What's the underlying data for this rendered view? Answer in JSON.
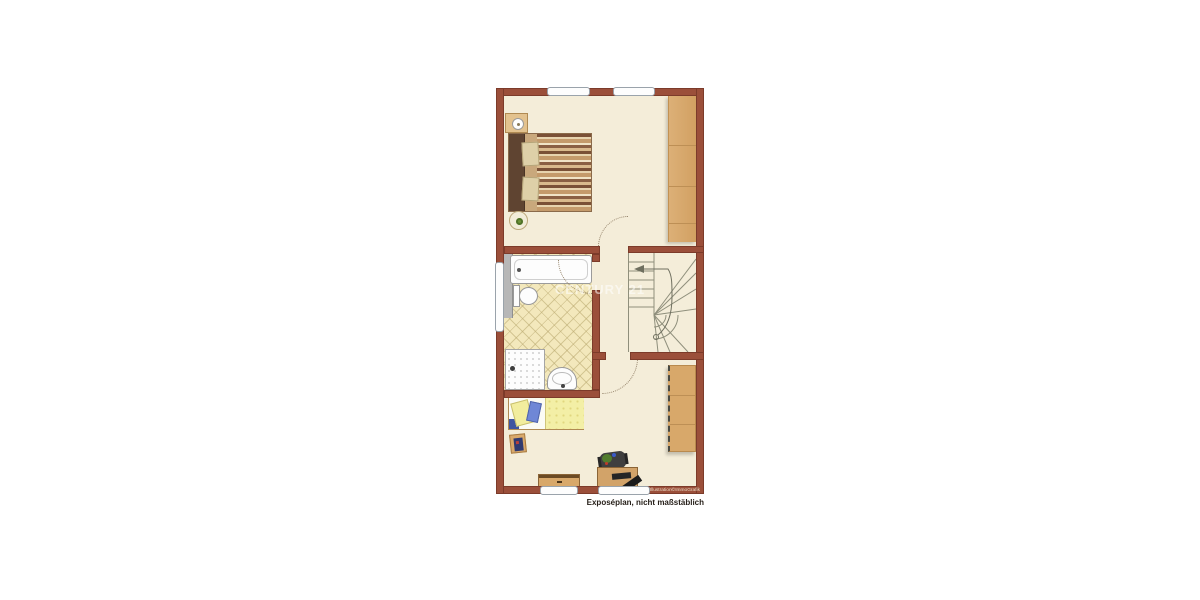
{
  "page": {
    "background": "#ffffff"
  },
  "plan": {
    "caption": "Exposéplan, nicht maßstäblich",
    "credit": "Illustration©ImmoGrafik",
    "watermark": "CENTURY 21",
    "palette": {
      "wall": "#9b4f3a",
      "floor": "#f4edd9",
      "wood": "#d8a86a",
      "tile": "#f3e8bc",
      "fixture_white": "#fdfdfd",
      "duvet_yellow": "#f3efa6",
      "cushion_blue": "#6f87d6"
    },
    "rooms": [
      {
        "name": "bedroom",
        "position": "top",
        "furniture": [
          "double-bed",
          "wardrobe",
          "nightstand-with-lamp",
          "round-plant-table"
        ]
      },
      {
        "name": "bathroom",
        "position": "middle-left",
        "furniture": [
          "bathtub",
          "toilet",
          "shower",
          "sink"
        ],
        "floor": "tiled"
      },
      {
        "name": "stair-hall",
        "position": "middle-right",
        "furniture": [
          "winder-staircase"
        ]
      },
      {
        "name": "children-room",
        "position": "bottom",
        "furniture": [
          "single-bed",
          "book",
          "shelf-unit",
          "desk",
          "office-chair",
          "desk-plant",
          "sideboard"
        ]
      }
    ],
    "openings": {
      "windows": [
        "top-wall-left",
        "top-wall-right",
        "left-wall-bathroom",
        "bottom-wall-left",
        "bottom-wall-right"
      ],
      "doors": [
        "bedroom-door",
        "bathroom-door",
        "children-room-door"
      ]
    }
  }
}
